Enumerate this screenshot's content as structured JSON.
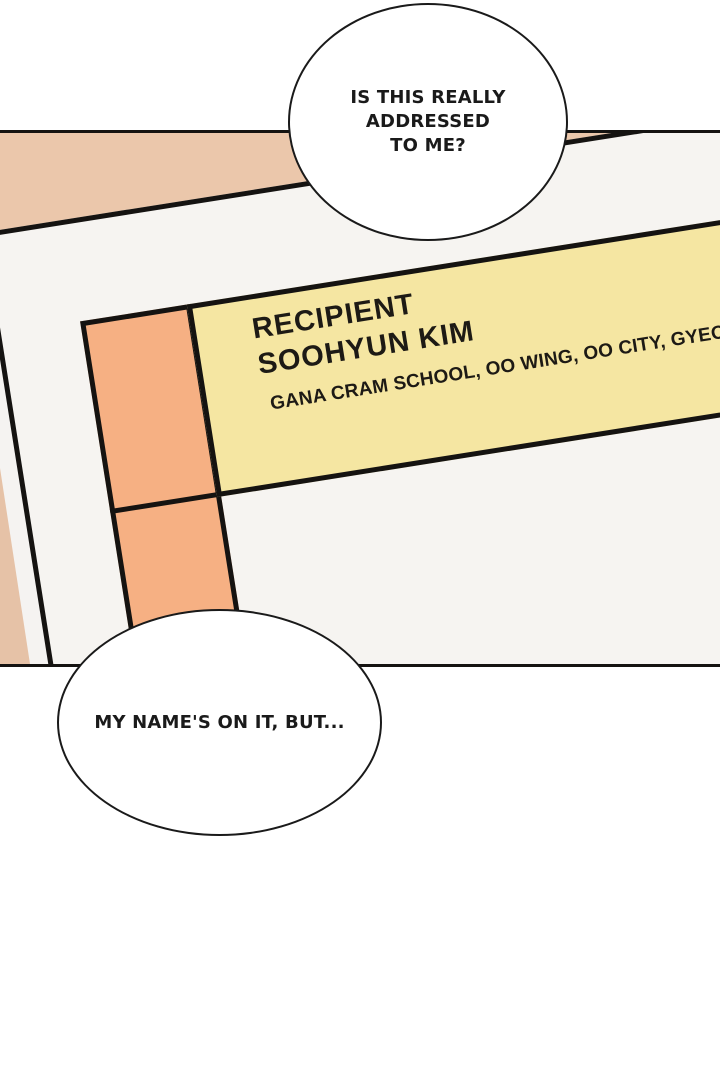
{
  "page_type": "webtoon-comic-panel",
  "panel": {
    "envelope": {
      "label": {
        "recipient_title": "RECIPIENT",
        "recipient_name": "SOOHYUN KIM",
        "address_line": "GANA CRAM SCHOOL, OO WING, OO CITY, GYEO"
      },
      "stamp_cells": 2
    }
  },
  "speech_bubbles": {
    "top": "IS THIS REALLY\nADDRESSED\nTO ME?",
    "bottom": "MY NAME'S ON IT, BUT..."
  },
  "colors": {
    "page_background": "#ffffff",
    "panel_background": "#f5f3f1",
    "desk_tan": "#ebc7ab",
    "envelope_white": "#f6f4f1",
    "stamp_orange": "#f6b083",
    "label_yellow": "#f5e6a2",
    "line_black": "#151311",
    "text_black": "#1d1a15"
  }
}
